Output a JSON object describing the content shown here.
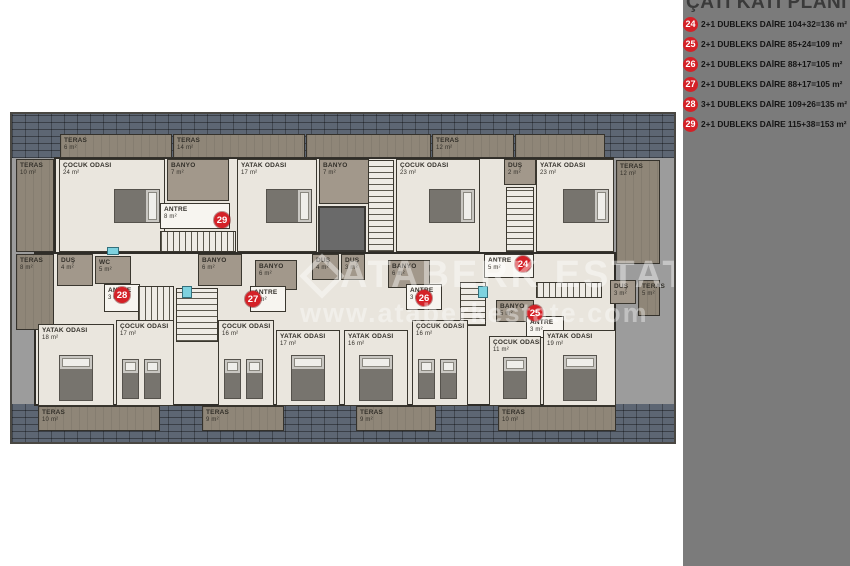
{
  "sidebar": {
    "title": "ÇATI KATI PLANI",
    "accent_color": "#d42127",
    "legend": [
      {
        "number": "24",
        "text": "2+1 DUBLEKS DAİRE 104+32=136 m²"
      },
      {
        "number": "25",
        "text": "2+1 DUBLEKS DAİRE 85+24=109 m²"
      },
      {
        "number": "26",
        "text": "2+1 DUBLEKS DAİRE 88+17=105 m²"
      },
      {
        "number": "27",
        "text": "2+1 DUBLEKS DAİRE 88+17=105 m²"
      },
      {
        "number": "28",
        "text": "3+1 DUBLEKS DAİRE 109+26=135 m²"
      },
      {
        "number": "29",
        "text": "2+1 DUBLEKS DAİRE 115+38=153 m²"
      }
    ]
  },
  "watermark": {
    "brand": "ATABERK ESTATE",
    "url": "www.ataberkestate.com"
  },
  "plan": {
    "areas": [
      {
        "label": "TERAS",
        "area": "6 m²",
        "x": 48,
        "y": 20,
        "w": 112,
        "h": 24,
        "type": "terrace"
      },
      {
        "label": "TERAS",
        "area": "14 m²",
        "x": 161,
        "y": 20,
        "w": 132,
        "h": 24,
        "type": "terrace"
      },
      {
        "label": "",
        "area": "",
        "x": 294,
        "y": 20,
        "w": 125,
        "h": 24,
        "type": "terrace"
      },
      {
        "label": "TERAS",
        "area": "12 m²",
        "x": 420,
        "y": 20,
        "w": 82,
        "h": 24,
        "type": "terrace"
      },
      {
        "label": "",
        "area": "",
        "x": 503,
        "y": 20,
        "w": 90,
        "h": 24,
        "type": "terrace"
      },
      {
        "label": "TERAS",
        "area": "10 m²",
        "x": 4,
        "y": 45,
        "w": 38,
        "h": 93,
        "type": "terrace"
      },
      {
        "label": "TERAS",
        "area": "8 m²",
        "x": 4,
        "y": 140,
        "w": 38,
        "h": 76,
        "type": "terrace"
      },
      {
        "label": "TERAS",
        "area": "12 m²",
        "x": 604,
        "y": 46,
        "w": 44,
        "h": 104,
        "type": "terrace"
      },
      {
        "label": "TERAS",
        "area": "5 m²",
        "x": 626,
        "y": 166,
        "w": 22,
        "h": 36,
        "type": "terrace"
      },
      {
        "label": "TERAS",
        "area": "10 m²",
        "x": 26,
        "y": 292,
        "w": 122,
        "h": 25,
        "type": "terrace"
      },
      {
        "label": "TERAS",
        "area": "9 m²",
        "x": 190,
        "y": 292,
        "w": 82,
        "h": 25,
        "type": "terrace"
      },
      {
        "label": "TERAS",
        "area": "9 m²",
        "x": 344,
        "y": 292,
        "w": 80,
        "h": 25,
        "type": "terrace"
      },
      {
        "label": "TERAS",
        "area": "10 m²",
        "x": 486,
        "y": 292,
        "w": 118,
        "h": 25,
        "type": "terrace"
      },
      {
        "label": "ÇOCUK ODASI",
        "area": "24 m²",
        "x": 47,
        "y": 45,
        "w": 106,
        "h": 93,
        "type": "room",
        "bed": "double-h"
      },
      {
        "label": "BANYO",
        "area": "7 m²",
        "x": 155,
        "y": 45,
        "w": 62,
        "h": 42,
        "type": "bath"
      },
      {
        "label": "ANTRE",
        "area": "8 m²",
        "x": 148,
        "y": 89,
        "w": 70,
        "h": 26,
        "type": "antre"
      },
      {
        "x": 148,
        "y": 117,
        "w": 76,
        "h": 21,
        "type": "stairs-h"
      },
      {
        "label": "YATAK ODASI",
        "area": "17 m²",
        "x": 225,
        "y": 45,
        "w": 80,
        "h": 93,
        "type": "room",
        "bed": "double-h"
      },
      {
        "label": "BANYO",
        "area": "7 m²",
        "x": 307,
        "y": 45,
        "w": 50,
        "h": 45,
        "type": "bath"
      },
      {
        "x": 306,
        "y": 92,
        "w": 48,
        "h": 46,
        "type": "elevator"
      },
      {
        "x": 356,
        "y": 46,
        "w": 26,
        "h": 92,
        "type": "stairs-v"
      },
      {
        "label": "ÇOCUK ODASI",
        "area": "23 m²",
        "x": 384,
        "y": 45,
        "w": 84,
        "h": 93,
        "type": "room",
        "bed": "double-h"
      },
      {
        "label": "DUŞ",
        "area": "2 m²",
        "x": 492,
        "y": 45,
        "w": 32,
        "h": 26,
        "type": "bath"
      },
      {
        "x": 494,
        "y": 73,
        "w": 28,
        "h": 65,
        "type": "stairs-v"
      },
      {
        "label": "YATAK ODASI",
        "area": "23 m²",
        "x": 524,
        "y": 45,
        "w": 78,
        "h": 93,
        "type": "room",
        "bed": "double-h"
      },
      {
        "label": "ANTRE",
        "area": "5 m²",
        "x": 472,
        "y": 140,
        "w": 50,
        "h": 24,
        "type": "antre"
      },
      {
        "label": "DUŞ",
        "area": "4 m²",
        "x": 45,
        "y": 140,
        "w": 36,
        "h": 32,
        "type": "bath"
      },
      {
        "label": "WC",
        "area": "5 m²",
        "x": 83,
        "y": 142,
        "w": 36,
        "h": 28,
        "type": "bath"
      },
      {
        "label": "ANTRE",
        "area": "3 m²",
        "x": 92,
        "y": 170,
        "w": 36,
        "h": 28,
        "type": "antre"
      },
      {
        "label": "BANYO",
        "area": "6 m²",
        "x": 186,
        "y": 140,
        "w": 44,
        "h": 32,
        "type": "bath"
      },
      {
        "x": 126,
        "y": 172,
        "w": 36,
        "h": 42,
        "type": "stairs-h"
      },
      {
        "x": 164,
        "y": 174,
        "w": 42,
        "h": 54,
        "type": "stairs-v"
      },
      {
        "label": "BANYO",
        "area": "6 m²",
        "x": 243,
        "y": 146,
        "w": 42,
        "h": 30,
        "type": "bath"
      },
      {
        "label": "DUŞ",
        "area": "4 m²",
        "x": 300,
        "y": 140,
        "w": 27,
        "h": 26,
        "type": "bath"
      },
      {
        "label": "DUŞ",
        "area": "3 m²",
        "x": 329,
        "y": 140,
        "w": 24,
        "h": 26,
        "type": "bath"
      },
      {
        "label": "ANTRE",
        "area": "3 m²",
        "x": 238,
        "y": 172,
        "w": 36,
        "h": 26,
        "type": "antre"
      },
      {
        "label": "BANYO",
        "area": "6 m²",
        "x": 376,
        "y": 146,
        "w": 42,
        "h": 28,
        "type": "bath"
      },
      {
        "label": "ANTRE",
        "area": "3 m²",
        "x": 394,
        "y": 170,
        "w": 36,
        "h": 26,
        "type": "antre"
      },
      {
        "label": "BANYO",
        "area": "5 m²",
        "x": 484,
        "y": 186,
        "w": 38,
        "h": 22,
        "type": "bath"
      },
      {
        "label": "ANTRE",
        "area": "3 m²",
        "x": 514,
        "y": 202,
        "w": 38,
        "h": 22,
        "type": "antre"
      },
      {
        "label": "DUŞ",
        "area": "3 m²",
        "x": 598,
        "y": 166,
        "w": 26,
        "h": 24,
        "type": "bath"
      },
      {
        "x": 524,
        "y": 168,
        "w": 66,
        "h": 16,
        "type": "stairs-h"
      },
      {
        "x": 448,
        "y": 168,
        "w": 26,
        "h": 44,
        "type": "stairs-v"
      },
      {
        "label": "YATAK ODASI",
        "area": "18 m²",
        "x": 26,
        "y": 210,
        "w": 76,
        "h": 82,
        "type": "room",
        "bed": "double-v"
      },
      {
        "label": "ÇOCUK ODASI",
        "area": "17 m²",
        "x": 104,
        "y": 206,
        "w": 58,
        "h": 86,
        "type": "room",
        "bed": "twin-v"
      },
      {
        "label": "ÇOCUK ODASI",
        "area": "16 m²",
        "x": 206,
        "y": 206,
        "w": 56,
        "h": 86,
        "type": "room",
        "bed": "twin-v"
      },
      {
        "label": "YATAK ODASI",
        "area": "17 m²",
        "x": 264,
        "y": 216,
        "w": 64,
        "h": 76,
        "type": "room",
        "bed": "double-v"
      },
      {
        "label": "YATAK ODASI",
        "area": "16 m²",
        "x": 332,
        "y": 216,
        "w": 64,
        "h": 76,
        "type": "room",
        "bed": "double-v"
      },
      {
        "label": "ÇOCUK ODASI",
        "area": "16 m²",
        "x": 400,
        "y": 206,
        "w": 56,
        "h": 86,
        "type": "room",
        "bed": "twin-v"
      },
      {
        "label": "ÇOCUK ODASI",
        "area": "11 m²",
        "x": 477,
        "y": 222,
        "w": 52,
        "h": 70,
        "type": "room",
        "bed": "single-v"
      },
      {
        "label": "YATAK ODASI",
        "area": "19 m²",
        "x": 531,
        "y": 216,
        "w": 73,
        "h": 76,
        "type": "room",
        "bed": "double-v"
      },
      {
        "x": 95,
        "y": 133,
        "w": 12,
        "h": 8,
        "type": "window"
      },
      {
        "x": 170,
        "y": 172,
        "w": 10,
        "h": 12,
        "type": "window"
      },
      {
        "x": 466,
        "y": 172,
        "w": 10,
        "h": 12,
        "type": "window"
      }
    ],
    "badges": [
      {
        "number": "29",
        "x": 210,
        "y": 106
      },
      {
        "number": "24",
        "x": 511,
        "y": 150
      },
      {
        "number": "28",
        "x": 110,
        "y": 181
      },
      {
        "number": "27",
        "x": 241,
        "y": 185
      },
      {
        "number": "26",
        "x": 412,
        "y": 184
      },
      {
        "number": "25",
        "x": 523,
        "y": 199
      }
    ]
  }
}
